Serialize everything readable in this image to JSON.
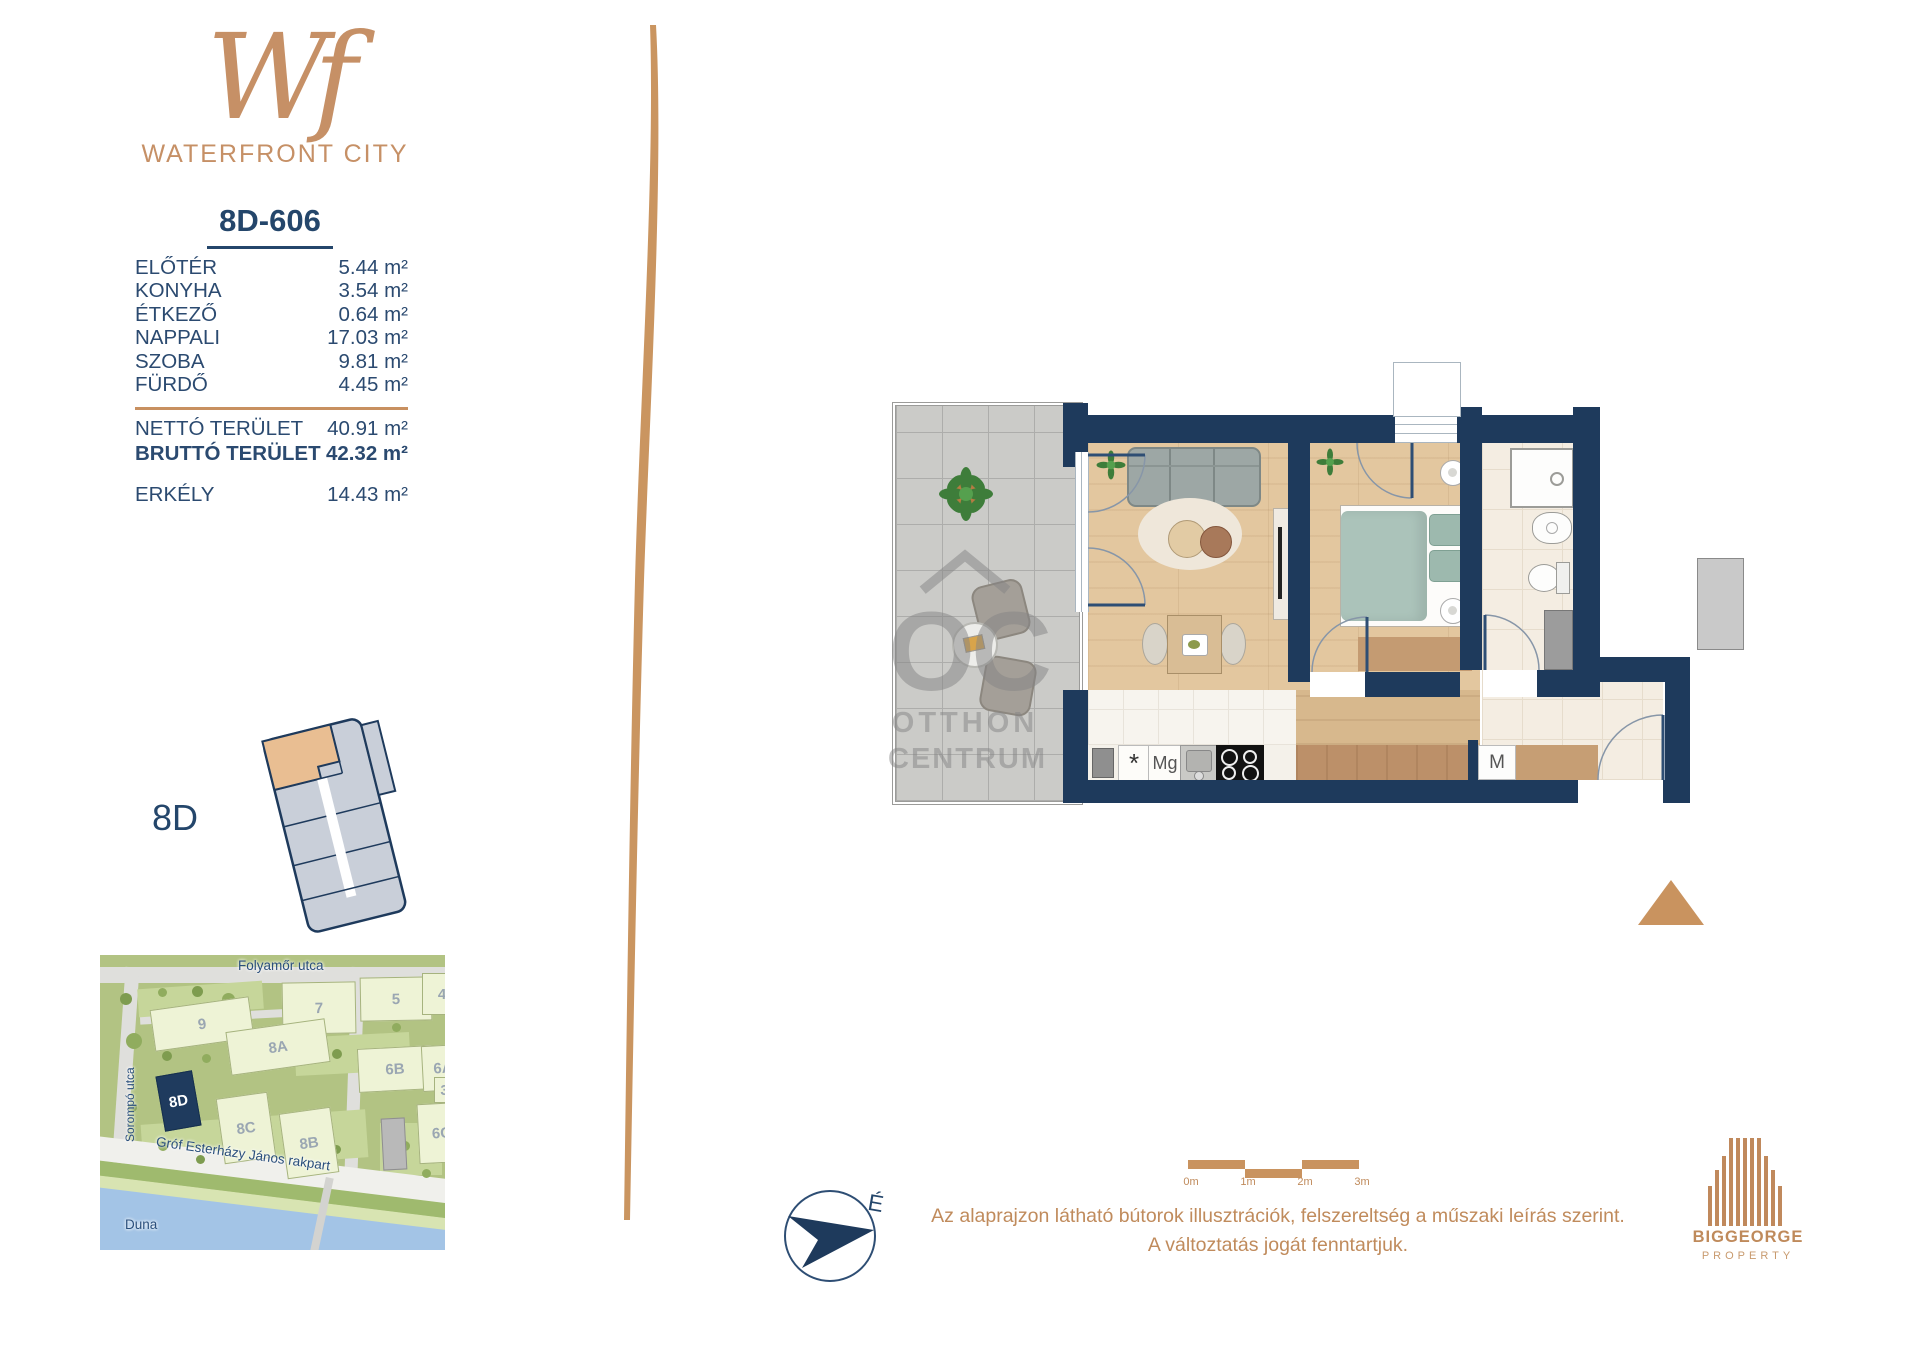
{
  "brand": {
    "monogram": "Wf",
    "name": "WATERFRONT CITY"
  },
  "unit": {
    "id": "8D-606",
    "rooms": [
      {
        "label": "ELŐTÉR",
        "area": "5.44 m²"
      },
      {
        "label": "KONYHA",
        "area": "3.54 m²"
      },
      {
        "label": "ÉTKEZŐ",
        "area": "0.64 m²"
      },
      {
        "label": "NAPPALI",
        "area": "17.03 m²"
      },
      {
        "label": "SZOBA",
        "area": "9.81 m²"
      },
      {
        "label": "FÜRDŐ",
        "area": "4.45 m²"
      }
    ],
    "net": {
      "label": "NETTÓ TERÜLET",
      "area": "40.91 m²"
    },
    "gross": {
      "label": "BRUTTÓ TERÜLET",
      "area": "42.32 m²"
    },
    "balcony": {
      "label": "ERKÉLY",
      "area": "14.43 m²"
    }
  },
  "building": {
    "label": "8D"
  },
  "map": {
    "streets": {
      "top": "Folyamőr utca",
      "left": "Sorompó utca",
      "bottom": "Gróf Esterházy János rakpart"
    },
    "river": "Duna",
    "highlighted_block": "8D",
    "blocks": [
      {
        "label": "9"
      },
      {
        "label": "7"
      },
      {
        "label": "5"
      },
      {
        "label": "4"
      },
      {
        "label": "8A"
      },
      {
        "label": "6B"
      },
      {
        "label": "6A"
      },
      {
        "label": "8D"
      },
      {
        "label": "8C"
      },
      {
        "label": "8B"
      },
      {
        "label": "6C"
      },
      {
        "label": "3C"
      }
    ]
  },
  "plan": {
    "appliances": {
      "fridge": "*",
      "microwave": "Mg",
      "washer": "M"
    },
    "compass": "É"
  },
  "watermark": {
    "monogram": "OC",
    "line1": "OTTHON",
    "line2": "CENTRUM"
  },
  "scalebar": {
    "t0": "0m",
    "t1": "1m",
    "t2": "2m",
    "t3": "3m"
  },
  "notes": {
    "line1": "Az alaprajzon látható bútorok illusztrációk, felszereltség a műszaki leírás szerint.",
    "line2": "A változtatás jogát fenntartjuk."
  },
  "developer": {
    "name": "BIGGEORGE",
    "tagline": "PROPERTY"
  },
  "colors": {
    "accent": "#C28E60",
    "navy": "#1E3A5C",
    "text_navy": "#2B4A70",
    "highlight_unit": "#E9BE92"
  }
}
